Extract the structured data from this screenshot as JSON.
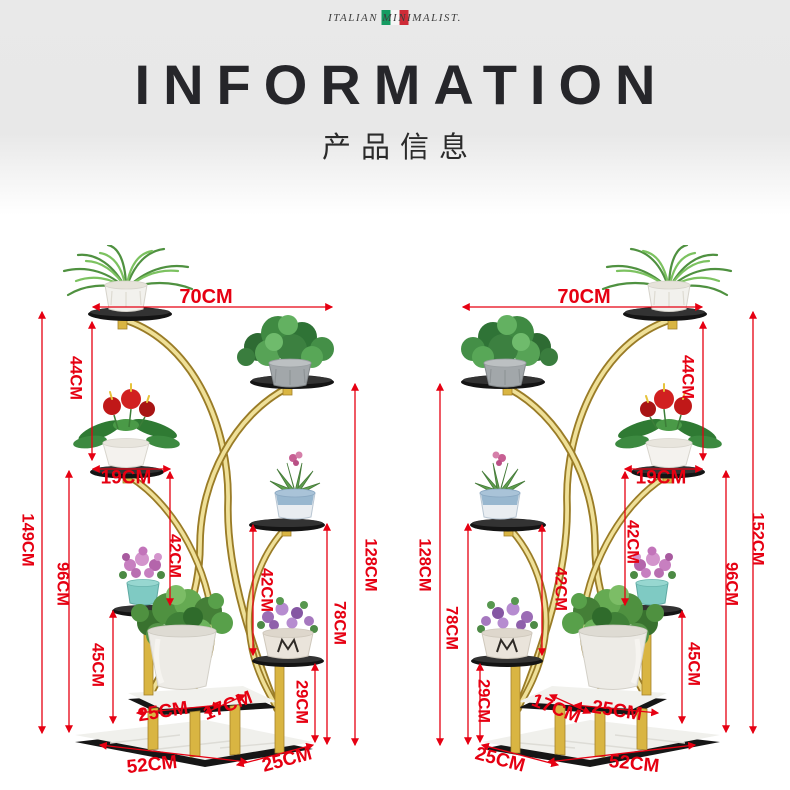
{
  "brand": {
    "logo_text": "ITALIAN MINIMALIST.",
    "flag_colors": {
      "green": "#169b62",
      "white": "#f6f6f6",
      "red": "#ce2b37"
    }
  },
  "header": {
    "title": "INFORMATION",
    "subtitle": "产品信息"
  },
  "accent": {
    "dimension_color": "#e60012",
    "gold": "#d9b542",
    "shelf_black": "#141414",
    "marble": "#f0f0ec"
  },
  "illustration": {
    "pot_monogram": "M",
    "description": "Two mirrored front views of a curved gold multi-tier flower stand with potted plants and red dimension annotations"
  },
  "stand_left": {
    "dims": {
      "top_width": "70CM",
      "tier1_height": "44CM",
      "shelf_width": "19CM",
      "overall_height": "149CM",
      "mid_column_height": "96CM",
      "lower_tier_height": "45CM",
      "upper_gap_height": "42CM",
      "lower_gap_height": "42CM",
      "foot_column_height": "29CM",
      "inner_height": "78CM",
      "frame_height": "128CM",
      "platform_depth": "25CM",
      "platform_side": "17CM",
      "base_length": "52CM",
      "base_depth": "25CM"
    }
  },
  "stand_right": {
    "dims": {
      "top_width": "70CM",
      "tier1_height": "44CM",
      "shelf_width": "19CM",
      "overall_height": "152CM",
      "mid_column_height": "96CM",
      "lower_tier_height": "45CM",
      "upper_gap_height": "42CM",
      "lower_gap_height": "42CM",
      "foot_column_height": "29CM",
      "inner_height": "78CM",
      "frame_height": "128CM",
      "platform_depth": "25CM",
      "platform_side": "17CM",
      "base_length": "52CM",
      "base_depth": "25CM"
    }
  }
}
